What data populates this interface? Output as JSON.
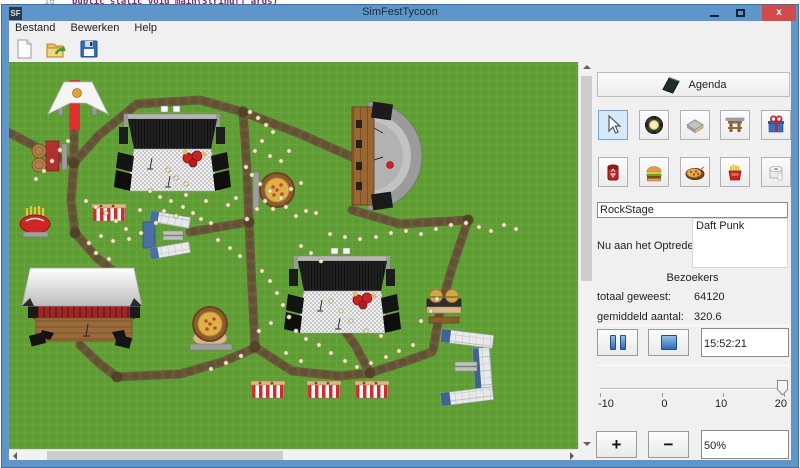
{
  "background": {
    "line_number": "10",
    "code_text": "public static void main(String[] args)"
  },
  "window": {
    "title": "SimFestTycoon",
    "icon_text": "SF",
    "titlebar_color": "#5e96cb",
    "close_color": "#d24b4b"
  },
  "menu": {
    "items": [
      "Bestand",
      "Bewerken",
      "Help"
    ]
  },
  "toolbar": {
    "buttons": [
      "new-document",
      "open-file",
      "save-file"
    ]
  },
  "map": {
    "colors": {
      "grass": "#5f9e33",
      "path": "#6d5c3c"
    },
    "paths": [
      "0,128 48,153 74,163",
      "74,104 74,166",
      "74,163 98,136 137,104 200,100 243,112",
      "243,112 298,133 352,157",
      "243,112 247,170 249,222",
      "249,222 190,232",
      "249,222 252,288 255,347",
      "255,347 292,371 340,376 370,373",
      "370,373 404,362 432,352",
      "370,373 355,345 344,330",
      "80,345 100,364 117,377 180,374 222,362 255,348",
      "74,163 71,200 75,233",
      "75,233 97,258 112,270",
      "352,210 400,224 468,220",
      "468,220 452,268 440,310 433,350"
    ],
    "junctions": [
      [
        74,
        163
      ],
      [
        243,
        112
      ],
      [
        249,
        222
      ],
      [
        255,
        347
      ],
      [
        370,
        373
      ],
      [
        75,
        233
      ],
      [
        117,
        377
      ],
      [
        468,
        220
      ]
    ],
    "people": [
      [
        60,
        150
      ],
      [
        52,
        161
      ],
      [
        44,
        171
      ],
      [
        36,
        179
      ],
      [
        68,
        141
      ],
      [
        250,
        112
      ],
      [
        258,
        118
      ],
      [
        266,
        125
      ],
      [
        273,
        132
      ],
      [
        262,
        141
      ],
      [
        255,
        151
      ],
      [
        270,
        156
      ],
      [
        281,
        161
      ],
      [
        289,
        151
      ],
      [
        246,
        167
      ],
      [
        252,
        175
      ],
      [
        260,
        184
      ],
      [
        270,
        191
      ],
      [
        281,
        198
      ],
      [
        291,
        189
      ],
      [
        301,
        183
      ],
      [
        265,
        201
      ],
      [
        257,
        209
      ],
      [
        273,
        209
      ],
      [
        286,
        207
      ],
      [
        247,
        219
      ],
      [
        296,
        216
      ],
      [
        306,
        211
      ],
      [
        316,
        213
      ],
      [
        330,
        234
      ],
      [
        345,
        237
      ],
      [
        360,
        239
      ],
      [
        376,
        237
      ],
      [
        391,
        233
      ],
      [
        406,
        231
      ],
      [
        421,
        234
      ],
      [
        436,
        229
      ],
      [
        451,
        225
      ],
      [
        466,
        223
      ],
      [
        479,
        227
      ],
      [
        491,
        231
      ],
      [
        504,
        225
      ],
      [
        516,
        229
      ],
      [
        150,
        191
      ],
      [
        160,
        197
      ],
      [
        171,
        201
      ],
      [
        183,
        207
      ],
      [
        193,
        213
      ],
      [
        201,
        219
      ],
      [
        211,
        223
      ],
      [
        176,
        216
      ],
      [
        164,
        211
      ],
      [
        156,
        223
      ],
      [
        186,
        195
      ],
      [
        206,
        201
      ],
      [
        86,
        201
      ],
      [
        96,
        207
      ],
      [
        106,
        213
      ],
      [
        116,
        221
      ],
      [
        126,
        229
      ],
      [
        101,
        236
      ],
      [
        89,
        243
      ],
      [
        113,
        241
      ],
      [
        129,
        239
      ],
      [
        141,
        233
      ],
      [
        96,
        253
      ],
      [
        109,
        259
      ],
      [
        262,
        271
      ],
      [
        270,
        281
      ],
      [
        277,
        293
      ],
      [
        283,
        305
      ],
      [
        289,
        317
      ],
      [
        271,
        323
      ],
      [
        259,
        331
      ],
      [
        296,
        331
      ],
      [
        306,
        339
      ],
      [
        319,
        345
      ],
      [
        331,
        353
      ],
      [
        345,
        361
      ],
      [
        357,
        367
      ],
      [
        371,
        363
      ],
      [
        386,
        357
      ],
      [
        399,
        351
      ],
      [
        413,
        345
      ],
      [
        301,
        361
      ],
      [
        286,
        353
      ],
      [
        241,
        356
      ],
      [
        226,
        363
      ],
      [
        211,
        369
      ],
      [
        331,
        301
      ],
      [
        341,
        311
      ],
      [
        351,
        321
      ],
      [
        366,
        331
      ],
      [
        381,
        336
      ],
      [
        421,
        321
      ],
      [
        431,
        311
      ],
      [
        437,
        299
      ],
      [
        301,
        246
      ],
      [
        311,
        253
      ],
      [
        321,
        261
      ],
      [
        168,
        170
      ],
      [
        176,
        178
      ],
      [
        186,
        184
      ],
      [
        140,
        210
      ],
      [
        228,
        205
      ],
      [
        236,
        198
      ],
      [
        218,
        240
      ],
      [
        230,
        248
      ],
      [
        240,
        256
      ]
    ]
  },
  "panel": {
    "agenda_label": "Agenda",
    "tools": [
      "select-cursor",
      "spotlight",
      "platform",
      "entrance-gate",
      "gift",
      "trash-can",
      "hamburger",
      "pizza",
      "fries",
      "toilet-paper"
    ],
    "selected_tool": "select-cursor",
    "selected_tool_color": "#d6e9f8",
    "stage_name_value": "RockStage",
    "now_performing_label": "Nu aan het Optreden:",
    "now_performing_value": "Daft Punk",
    "visitors_header": "Bezoekers",
    "total_label": "totaal geweest:",
    "total_value": "64120",
    "average_label": "gemiddeld aantal:",
    "average_value": "320.6",
    "time_value": "15:52:21",
    "slider": {
      "tick_labels": [
        "-10",
        "0",
        "10",
        "20"
      ],
      "value": 20
    },
    "plus_label": "+",
    "minus_label": "−",
    "zoom_value": "50%"
  }
}
